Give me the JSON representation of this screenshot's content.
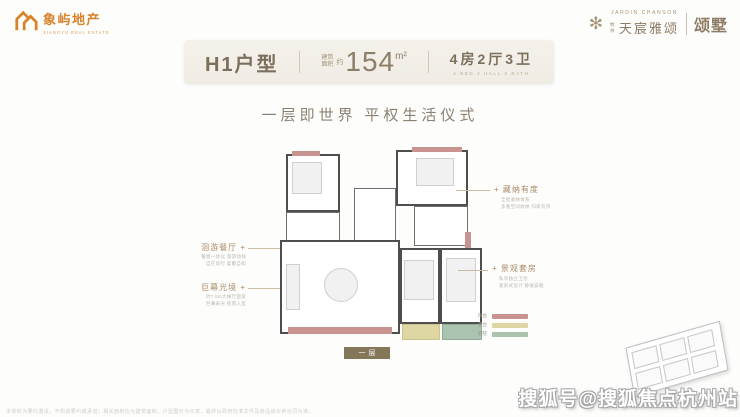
{
  "brand": {
    "name": "象屿地产",
    "subtext": "XIANGYU REAL ESTATE",
    "color": "#d9822b"
  },
  "project": {
    "en": "JARDIN CHANSON",
    "prefix": "杭州",
    "name": "天宸雅颂",
    "sub": "颂墅",
    "color": "#8d7c64"
  },
  "header": {
    "unit": "H1户型",
    "area_label_line1": "建筑",
    "area_label_line2": "面积",
    "area_approx": "约",
    "area_value": "154",
    "area_unit": "m²",
    "rooms": "4房2厅3卫",
    "rooms_caption": "4 BED 2 HALL 3 BATH"
  },
  "tagline": "一层即世界  平权生活仪式",
  "floorplan": {
    "floor_tag": "一层",
    "wall_color": "#4e4e4e",
    "accent_color": "#c9938f",
    "callout_marker": "+",
    "legend": [
      {
        "label": "阳台",
        "color": "#c9938f"
      },
      {
        "label": "露台",
        "color": "#ded7a3"
      },
      {
        "label": "庭院",
        "color": "#a9c3ae"
      }
    ],
    "annotations_left": [
      {
        "title": "洄游餐厅",
        "desc1": "餐厨一体化 洄游动线",
        "desc2": "自在穿行 宴聚自如"
      },
      {
        "title": "巨幕光境",
        "desc1": "约7.8m大横厅面宽",
        "desc2": "巨幕采光 揽景入室"
      }
    ],
    "annotations_right": [
      {
        "title": "藏纳有度",
        "desc1": "全屋收纳体系",
        "desc2": "多重空间收纳 归家有序"
      },
      {
        "title": "景观套房",
        "desc1": "私享独立卫浴",
        "desc2": "套房式设计 静谧安眠"
      }
    ]
  },
  "watermark": "搜狐号@搜狐焦点杭州站",
  "disclaimer": "本资料为要约邀请，不构成要约或承诺；相关面积均为建筑面积，户型图仅为示意，最终以政府批准文件及商品房买卖合同为准。"
}
